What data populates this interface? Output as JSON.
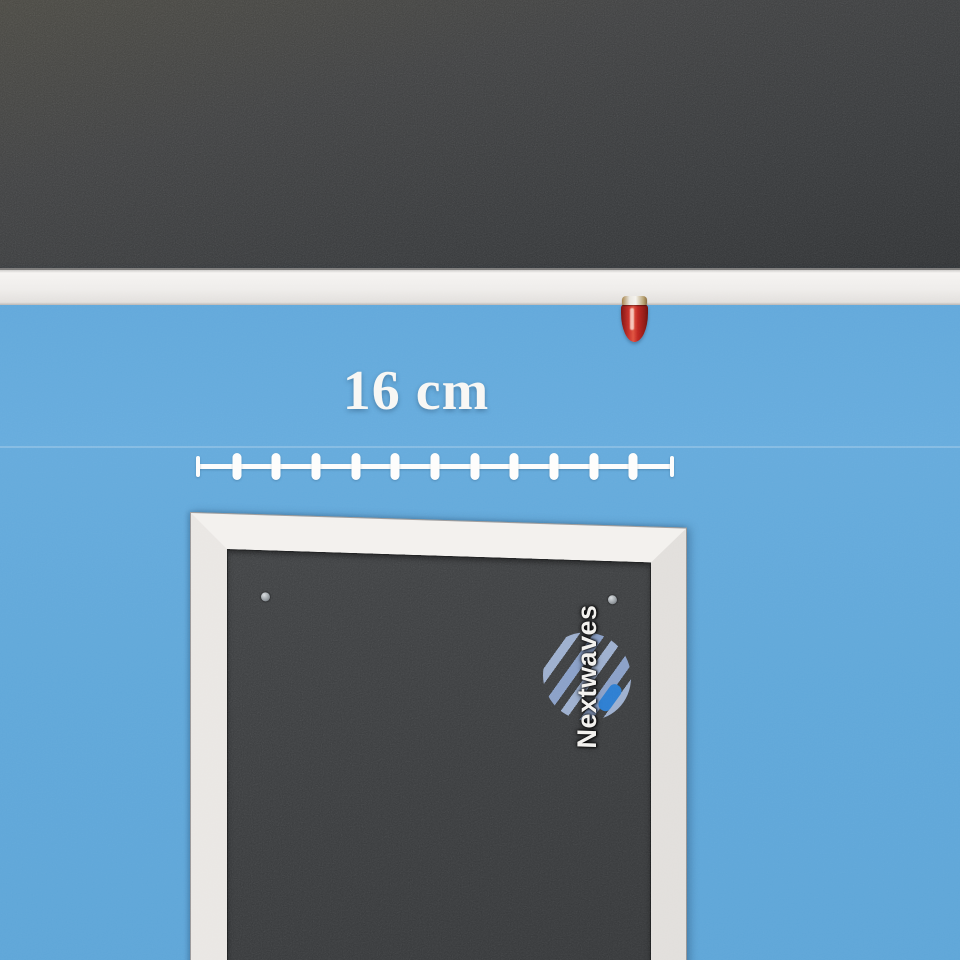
{
  "photo": {
    "measurement": {
      "label": "16 cm",
      "ruler_interior_ticks": 11,
      "ruler_segments": 12
    },
    "logo": {
      "text": "Nextwaves"
    },
    "colors": {
      "wall_blue": "#64aadb",
      "felt_dark": "#38393b",
      "frame_white": "#edeae7",
      "rail_white": "#efedea",
      "pin_red": "#c1272b",
      "logo_stripe": "#8fa6cf",
      "logo_accent": "#2e7fd2",
      "label_white": "#f8f7f4"
    }
  }
}
